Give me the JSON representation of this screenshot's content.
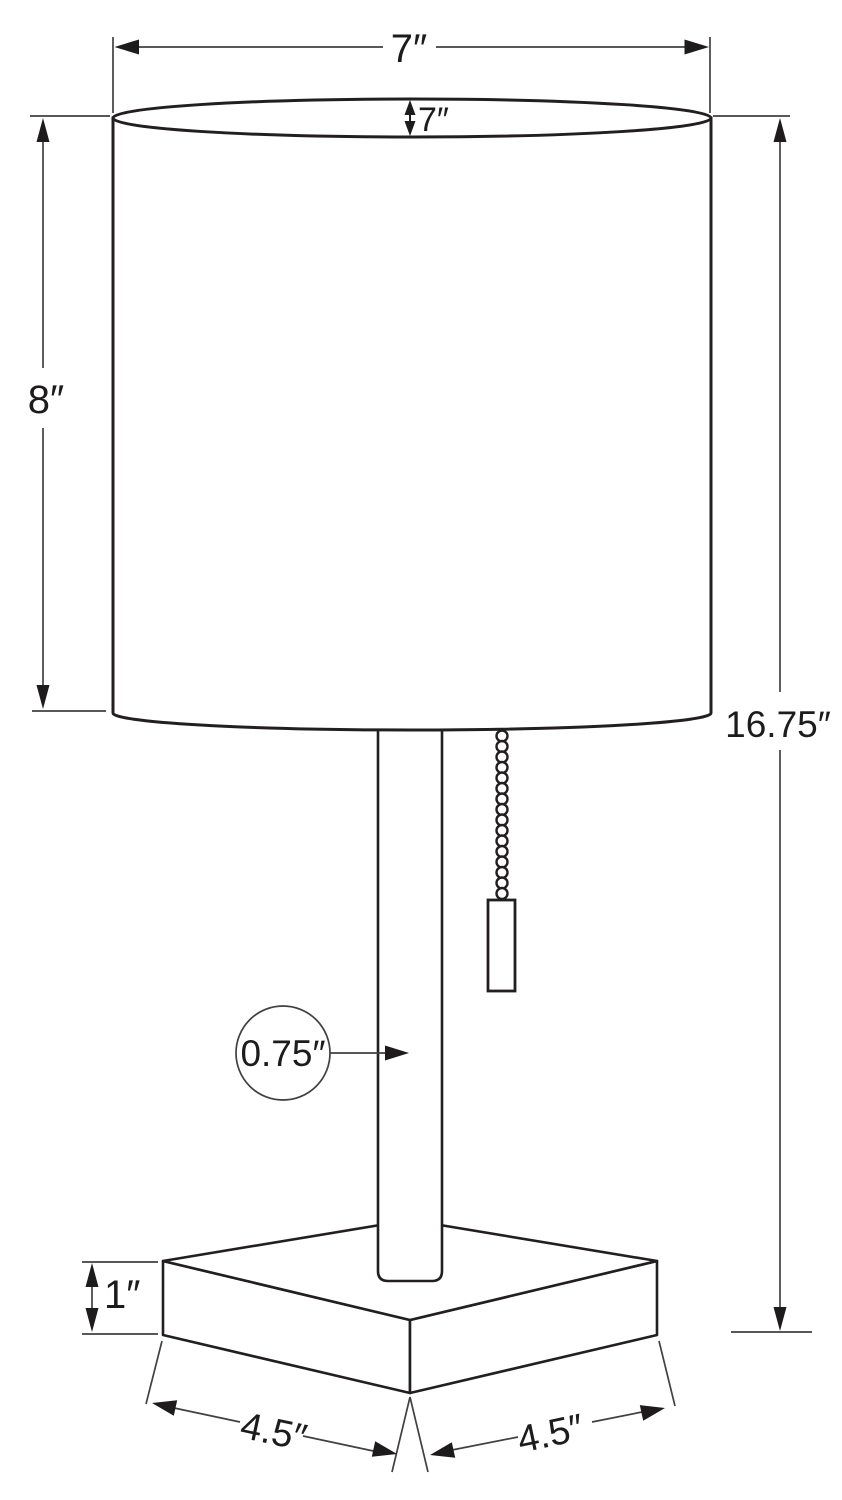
{
  "page": {
    "background": "#ffffff"
  },
  "diagram": {
    "colors": {
      "outline": "#231f20",
      "dimension_line": "#414042",
      "label_text": "#1d1b1c"
    },
    "labels": {
      "shade_width": "7″",
      "shade_top_depth": "7″",
      "shade_height": "8″",
      "overall_height": "16.75″",
      "pole_diameter": "0.75″",
      "base_height": "1″",
      "base_depth": "4.5″",
      "base_width": "4.5″"
    }
  }
}
